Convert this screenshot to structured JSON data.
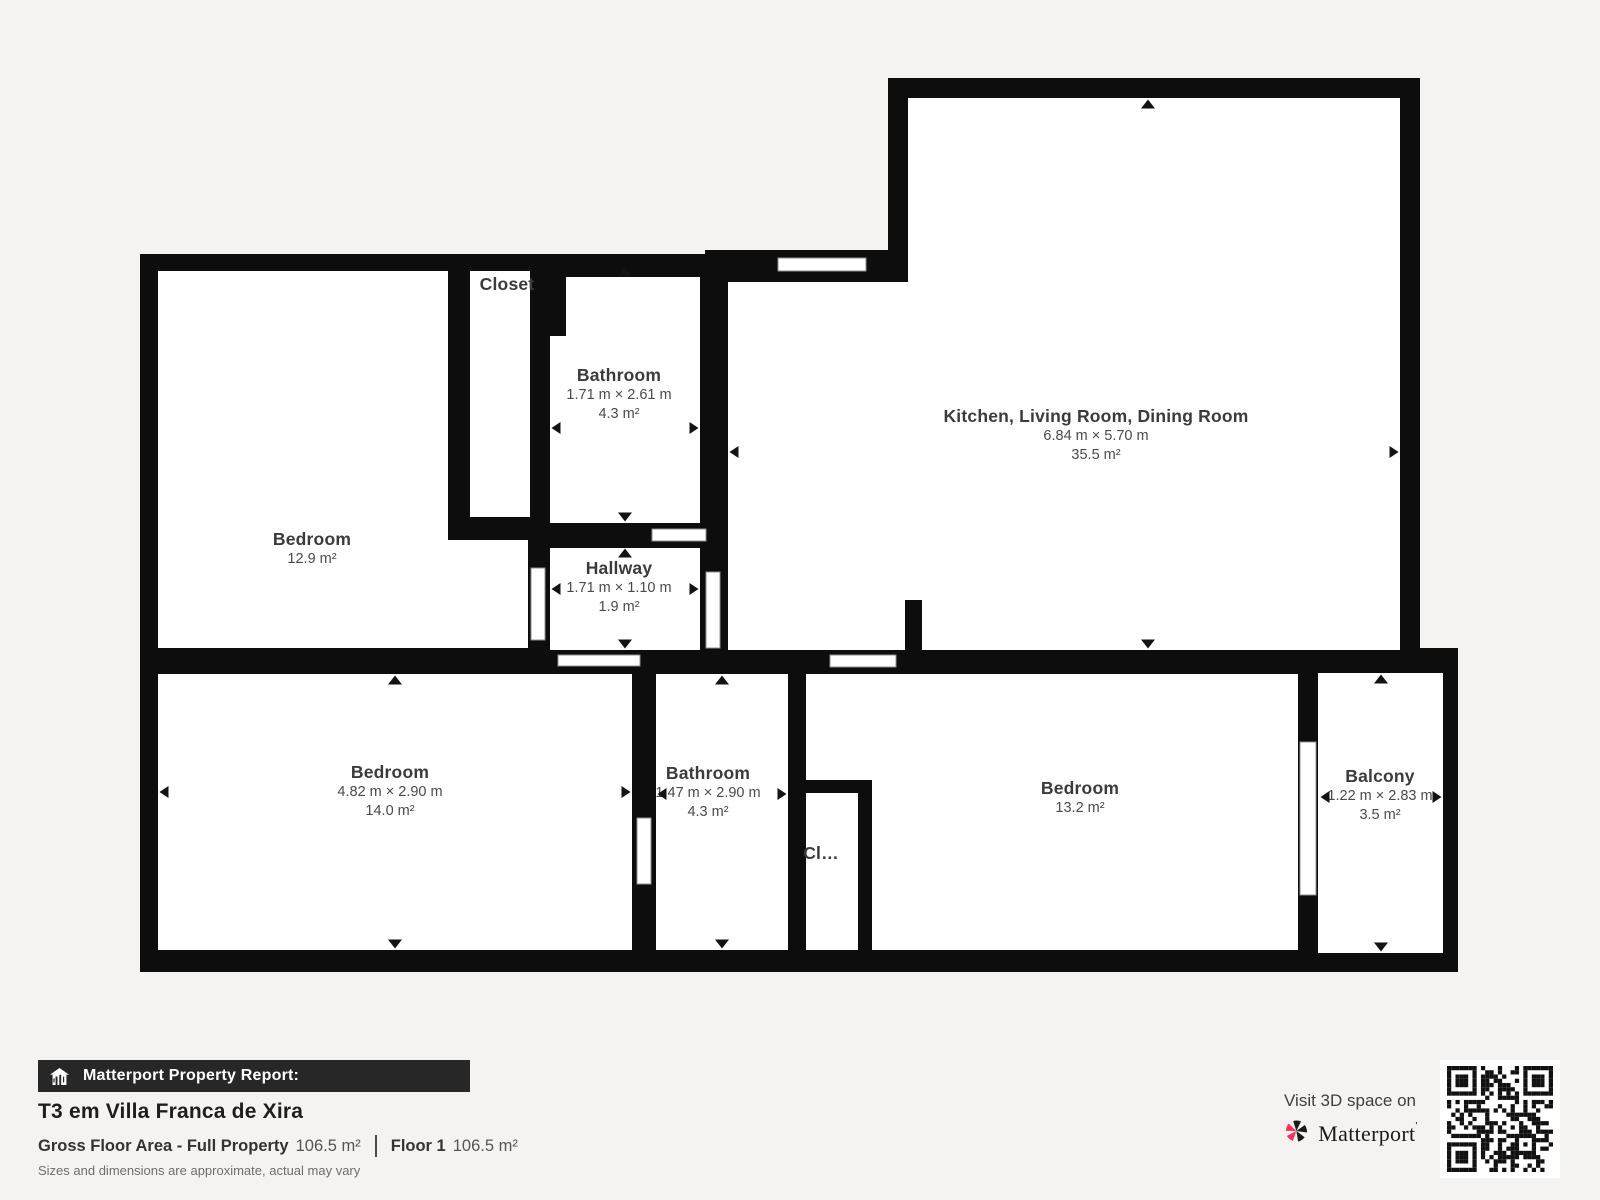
{
  "colors": {
    "background": "#f4f3f1",
    "wall": "#0d0d0d",
    "floor": "#ffffff",
    "label_text": "#3b3b3b",
    "brand_pink": "#ff3158",
    "report_bar": "#272727"
  },
  "plan": {
    "rooms": [
      {
        "id": "bedroom-top-left",
        "name": "Bedroom",
        "area": "12.9 m²",
        "label": {
          "x": 312,
          "y": 529
        }
      },
      {
        "id": "closet-top",
        "name": "Closet",
        "label": {
          "x": 507,
          "y": 274
        }
      },
      {
        "id": "bathroom-top",
        "name": "Bathroom",
        "dimensions": "1.71 m × 2.61 m",
        "area": "4.3 m²",
        "label": {
          "x": 619,
          "y": 365
        }
      },
      {
        "id": "hallway",
        "name": "Hallway",
        "dimensions": "1.71 m × 1.10 m",
        "area": "1.9 m²",
        "label": {
          "x": 619,
          "y": 558
        }
      },
      {
        "id": "kitchen-living-dining",
        "name": "Kitchen, Living Room, Dining Room",
        "dimensions": "6.84 m × 5.70 m",
        "area": "35.5 m²",
        "label": {
          "x": 1096,
          "y": 406
        }
      },
      {
        "id": "bedroom-bottom-left",
        "name": "Bedroom",
        "dimensions": "4.82 m × 2.90 m",
        "area": "14.0 m²",
        "label": {
          "x": 390,
          "y": 762
        }
      },
      {
        "id": "bathroom-bottom",
        "name": "Bathroom",
        "dimensions": "1.47 m × 2.90 m",
        "area": "4.3 m²",
        "label": {
          "x": 708,
          "y": 763
        }
      },
      {
        "id": "closet-bottom",
        "name": "Cl…",
        "label": {
          "x": 821,
          "y": 843
        }
      },
      {
        "id": "bedroom-bottom-right",
        "name": "Bedroom",
        "area": "13.2 m²",
        "label": {
          "x": 1080,
          "y": 778
        }
      },
      {
        "id": "balcony",
        "name": "Balcony",
        "dimensions": "1.22 m × 2.83 m",
        "area": "3.5 m²",
        "label": {
          "x": 1380,
          "y": 766
        }
      }
    ],
    "dimension_arrows": [
      {
        "dir": "up",
        "x": 625,
        "y": 272
      },
      {
        "dir": "down",
        "x": 625,
        "y": 517
      },
      {
        "dir": "left",
        "x": 556,
        "y": 428
      },
      {
        "dir": "right",
        "x": 694,
        "y": 428
      },
      {
        "dir": "up",
        "x": 625,
        "y": 553
      },
      {
        "dir": "down",
        "x": 625,
        "y": 644
      },
      {
        "dir": "left",
        "x": 556,
        "y": 589
      },
      {
        "dir": "right",
        "x": 694,
        "y": 589
      },
      {
        "dir": "up",
        "x": 1148,
        "y": 104
      },
      {
        "dir": "down",
        "x": 1148,
        "y": 644
      },
      {
        "dir": "left",
        "x": 734,
        "y": 452
      },
      {
        "dir": "right",
        "x": 1394,
        "y": 452
      },
      {
        "dir": "up",
        "x": 395,
        "y": 680
      },
      {
        "dir": "down",
        "x": 395,
        "y": 944
      },
      {
        "dir": "left",
        "x": 164,
        "y": 792
      },
      {
        "dir": "right",
        "x": 626,
        "y": 792
      },
      {
        "dir": "up",
        "x": 722,
        "y": 680
      },
      {
        "dir": "down",
        "x": 722,
        "y": 944
      },
      {
        "dir": "left",
        "x": 662,
        "y": 794
      },
      {
        "dir": "right",
        "x": 782,
        "y": 794
      },
      {
        "dir": "up",
        "x": 1381,
        "y": 679
      },
      {
        "dir": "down",
        "x": 1381,
        "y": 947
      },
      {
        "dir": "left",
        "x": 1325,
        "y": 797
      },
      {
        "dir": "right",
        "x": 1437,
        "y": 797
      }
    ]
  },
  "footer": {
    "report_label": "Matterport Property Report:",
    "property_title": "T3 em Villa Franca de Xira",
    "gross_floor_area_label": "Gross Floor Area - Full Property",
    "gross_floor_area_value": "106.5 m²",
    "floor_label": "Floor 1",
    "floor_value": "106.5 m²",
    "disclaimer": "Sizes and dimensions are approximate, actual may vary",
    "visit_label": "Visit 3D space on",
    "brand": "Matterport",
    "brand_mark": "'"
  }
}
